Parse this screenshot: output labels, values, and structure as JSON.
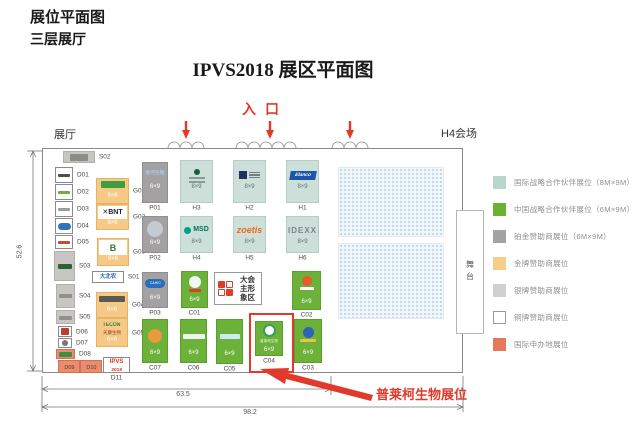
{
  "page": {
    "heading1": "展位平面图",
    "heading2": "三层展厅",
    "title": "IPVS2018 展区平面图",
    "entrance": "入口",
    "hall_left_label": "展厅",
    "hall_right_label": "H4会场",
    "stage_label": "舞台",
    "conference_area": {
      "line1": "大会",
      "line2": "主形象区"
    },
    "callout": "普莱柯生物展位"
  },
  "dimensions": {
    "left": "52.6",
    "bottom_inner": "63.5",
    "bottom_outer": "98.2"
  },
  "legend": [
    {
      "label": "国际战略合作伙伴展位（8M×9M）",
      "color": "#b7d6cc"
    },
    {
      "label": "中国战略合作伙伴展位（6M×9M）",
      "color": "#6ab234"
    },
    {
      "label": "铂金赞助商展位（6M×9M）",
      "color": "#a3a3a3"
    },
    {
      "label": "金牌赞助商展位",
      "color": "#f7cd8c"
    },
    {
      "label": "银牌赞助商展位",
      "color": "#d2cfcf"
    },
    {
      "label": "铜牌赞助商展位",
      "color": "#ffffff",
      "border": "#999999"
    },
    {
      "label": "国际申办地展位",
      "color": "#e8785c"
    }
  ],
  "colors": {
    "booth": {
      "teal": "#ccdfd9",
      "green": "#6cb23a",
      "platinum": "#a3a1a1",
      "gold": "#f6c987",
      "silver": "#c8c6c2",
      "white": "#ffffff",
      "coral": "#e88d6e"
    },
    "border": {
      "teal": "#b2cec6",
      "green": "#58a028",
      "platinum": "#908e8e",
      "gold": "#e3b368",
      "silver": "#b2b0ac",
      "white": "#8a8a8a",
      "coral": "#d2714f"
    },
    "sizetext": {
      "teal": "#60736e",
      "green": "#ffffff",
      "platinum": "#ffffff",
      "gold": "#ffffff",
      "silver": "#555555",
      "white": "#555555",
      "coral": "#ffffff"
    },
    "accent_red": "#e03a2c",
    "wall": "#8a8a8a",
    "dim": "#777777"
  },
  "booths": [
    {
      "id": "S02",
      "x": 63,
      "y": 151,
      "w": 32,
      "h": 12,
      "fill": "silver",
      "label": "S02",
      "side": "right",
      "logo": {
        "kind": "chip",
        "bg": "#8d8d85",
        "w": 18,
        "h": 7,
        "mt": 2
      }
    },
    {
      "id": "D01",
      "x": 55,
      "y": 167,
      "w": 18,
      "h": 16,
      "fill": "white",
      "label": "D01",
      "side": "right",
      "logo": {
        "kind": "chip",
        "bg": "#50504e",
        "w": 12,
        "h": 3,
        "mt": 6
      }
    },
    {
      "id": "D02",
      "x": 55,
      "y": 184,
      "w": 18,
      "h": 16,
      "fill": "white",
      "label": "D02",
      "side": "right",
      "logo": {
        "kind": "chip",
        "bg": "#6fae3e",
        "w": 12,
        "h": 3,
        "mt": 6
      }
    },
    {
      "id": "D03",
      "x": 55,
      "y": 201,
      "w": 18,
      "h": 16,
      "fill": "white",
      "label": "D03",
      "side": "right",
      "logo": {
        "kind": "chip",
        "bg": "#9c9c9c",
        "w": 12,
        "h": 3,
        "mt": 6
      }
    },
    {
      "id": "D04",
      "x": 55,
      "y": 218,
      "w": 18,
      "h": 16,
      "fill": "white",
      "label": "D04",
      "side": "right",
      "logo": {
        "kind": "pill",
        "bg": "#2f74ba",
        "w": 13,
        "h": 7,
        "mt": 4
      }
    },
    {
      "id": "D05",
      "x": 55,
      "y": 235,
      "w": 18,
      "h": 14,
      "fill": "white",
      "label": "D05",
      "side": "right",
      "logo": {
        "kind": "chip",
        "bg": "#cc4b36",
        "w": 12,
        "h": 3,
        "mt": 5
      }
    },
    {
      "id": "S03",
      "x": 54,
      "y": 251,
      "w": 21,
      "h": 30,
      "fill": "silver",
      "label": "S03",
      "side": "right",
      "logo": {
        "kind": "chip",
        "bg": "#315f35",
        "w": 14,
        "h": 5,
        "mt": 12
      }
    },
    {
      "id": "S04",
      "x": 56,
      "y": 284,
      "w": 19,
      "h": 24,
      "fill": "silver",
      "label": "S04",
      "side": "right",
      "logo": {
        "kind": "chip",
        "bg": "#8f8f8f",
        "w": 13,
        "h": 4,
        "mt": 9
      }
    },
    {
      "id": "S05",
      "x": 56,
      "y": 310,
      "w": 19,
      "h": 14,
      "fill": "silver",
      "label": "S05",
      "side": "right",
      "logo": {
        "kind": "chip",
        "bg": "#909090",
        "w": 13,
        "h": 4,
        "mt": 5
      }
    },
    {
      "id": "D06",
      "x": 58,
      "y": 326,
      "w": 14,
      "h": 11,
      "fill": "white",
      "label": "D06",
      "side": "right",
      "logo": {
        "kind": "chip",
        "bg": "#c13b2e",
        "w": 8,
        "h": 7,
        "mt": 1
      }
    },
    {
      "id": "D07",
      "x": 58,
      "y": 338,
      "w": 14,
      "h": 10,
      "fill": "white",
      "label": "D07",
      "side": "right",
      "logo": {
        "kind": "circle",
        "bg": "#777777",
        "d": 6,
        "mt": 1
      }
    },
    {
      "id": "D08",
      "x": 56,
      "y": 349,
      "w": 19,
      "h": 10,
      "fill": "coral",
      "label": "D08",
      "side": "right",
      "logo": {
        "kind": "chip",
        "bg": "#3f8f3f",
        "w": 13,
        "h": 5,
        "mt": 2
      }
    },
    {
      "id": "D09",
      "x": 58,
      "y": 360,
      "w": 22,
      "h": 13,
      "fill": "coral",
      "inner": "D09"
    },
    {
      "id": "D10",
      "x": 80,
      "y": 360,
      "w": 22,
      "h": 13,
      "fill": "coral",
      "inner": "D10"
    },
    {
      "id": "D11",
      "x": 103,
      "y": 357,
      "w": 27,
      "h": 16,
      "fill": "white",
      "label": "D11",
      "side": "bottom",
      "logo": {
        "kind": "stack",
        "gap": 0,
        "mt": 1,
        "items": [
          {
            "kind": "text",
            "text": "IPVS",
            "color": "#d43a2a",
            "size": 6,
            "weight": 700
          },
          {
            "kind": "text",
            "text": "2018",
            "color": "#d43a2a",
            "size": 6,
            "scale": 0.8,
            "weight": 700
          }
        ]
      }
    },
    {
      "id": "G01",
      "x": 96,
      "y": 178,
      "w": 33,
      "h": 26,
      "fill": "gold",
      "size": "6×6",
      "sy": 4,
      "label": "G01",
      "side": "right",
      "logo": {
        "kind": "chip",
        "bg": "#3f9e3f",
        "w": 24,
        "h": 7,
        "mt": 2
      }
    },
    {
      "id": "G02",
      "x": 96,
      "y": 204,
      "w": 33,
      "h": 26,
      "fill": "gold",
      "size": "6×6",
      "sy": 3,
      "label": "G02",
      "side": "right",
      "logo": {
        "kind": "banner",
        "bg": "#ffffff",
        "w": 29,
        "h": 13,
        "text": "✕BNT",
        "color": "#222222",
        "size": 7,
        "weight": 700,
        "mt": 1
      }
    },
    {
      "id": "G03",
      "x": 97,
      "y": 238,
      "w": 32,
      "h": 28,
      "fill": "gold",
      "size": "6×6",
      "sy": 3,
      "label": "G03",
      "side": "right",
      "logo": {
        "kind": "banner",
        "bg": "#ffffff",
        "w": 28,
        "h": 15,
        "text": "B",
        "color": "#2e7d32",
        "size": 9,
        "weight": 700,
        "mt": 1
      }
    },
    {
      "id": "S01",
      "x": 92,
      "y": 271,
      "w": 32,
      "h": 12,
      "fill": "white",
      "label": "S01",
      "side": "right",
      "logo": {
        "kind": "text",
        "text": "大北农",
        "color": "#1b5fb0",
        "size": 6,
        "scale": 0.9,
        "weight": 700,
        "mt": 2
      }
    },
    {
      "id": "G04",
      "x": 96,
      "y": 292,
      "w": 32,
      "h": 26,
      "fill": "gold",
      "size": "6×6",
      "sy": 4,
      "label": "G04",
      "side": "right",
      "logo": {
        "kind": "chip",
        "bg": "#5a5a52",
        "w": 26,
        "h": 6,
        "mt": 3
      }
    },
    {
      "id": "G05",
      "x": 96,
      "y": 318,
      "w": 32,
      "h": 29,
      "fill": "gold",
      "size": "6×6",
      "sy": 3,
      "label": "G05",
      "side": "right",
      "logo": {
        "kind": "stack",
        "gap": 0,
        "mt": 3,
        "items": [
          {
            "kind": "text",
            "text": "TECON",
            "color": "#2f7d3a",
            "size": 6,
            "scale": 0.85,
            "weight": 700
          },
          {
            "kind": "text",
            "text": "天康生物",
            "color": "#8a3a2a",
            "size": 6,
            "scale": 0.75
          }
        ]
      }
    },
    {
      "id": "P01",
      "x": 142,
      "y": 162,
      "w": 26,
      "h": 41,
      "fill": "platinum",
      "size": "6×9",
      "sy": 12,
      "label": "P01",
      "side": "bottom",
      "logo": {
        "kind": "text",
        "text": "金河生物",
        "color": "#a9c9ea",
        "size": 6,
        "scale": 0.8,
        "weight": 700,
        "mt": 7
      }
    },
    {
      "id": "P02",
      "x": 142,
      "y": 216,
      "w": 26,
      "h": 37,
      "fill": "platinum",
      "size": "6×9",
      "sy": 6,
      "label": "P02",
      "side": "bottom",
      "logo": {
        "kind": "circle",
        "bg": "#c2cbd2",
        "d": 16,
        "mt": 4
      }
    },
    {
      "id": "P03",
      "x": 142,
      "y": 272,
      "w": 26,
      "h": 36,
      "fill": "platinum",
      "size": "6×9",
      "sy": 6,
      "label": "P03",
      "side": "bottom",
      "logo": {
        "kind": "pill",
        "bg": "#2a6db8",
        "w": 20,
        "h": 9,
        "text": "CAHIC",
        "color": "#ffffff",
        "size": 6,
        "scale": 0.6,
        "mt": 6
      }
    },
    {
      "id": "H3",
      "x": 180,
      "y": 160,
      "w": 33,
      "h": 43,
      "fill": "teal",
      "size": "8×9",
      "sy": 12,
      "label": "H3",
      "side": "bottom",
      "logo": {
        "kind": "dotlines",
        "dot": "#1d5c3c",
        "lines": "#8a9a94",
        "mt": 8
      }
    },
    {
      "id": "H2",
      "x": 233,
      "y": 160,
      "w": 33,
      "h": 43,
      "fill": "teal",
      "size": "8×9",
      "sy": 12,
      "label": "H2",
      "side": "bottom",
      "logo": {
        "kind": "chiplines",
        "sq": "#1d2f5e",
        "lines": "#6f7f8a",
        "mt": 10
      }
    },
    {
      "id": "H1",
      "x": 286,
      "y": 160,
      "w": 33,
      "h": 43,
      "fill": "teal",
      "size": "8×9",
      "sy": 12,
      "label": "H1",
      "side": "bottom",
      "logo": {
        "kind": "banner",
        "bg": "#1b57a6",
        "w": 26,
        "h": 9,
        "skew": -10,
        "text": "Elanco",
        "color": "#ffffff",
        "size": 6,
        "scale": 0.8,
        "weight": 700,
        "italic": true,
        "mt": 10
      }
    },
    {
      "id": "H4",
      "x": 180,
      "y": 216,
      "w": 33,
      "h": 37,
      "fill": "teal",
      "size": "8×9",
      "sy": 7,
      "label": "H4",
      "side": "bottom",
      "logo": {
        "kind": "stack",
        "dir": "row",
        "gap": 2,
        "mt": 9,
        "items": [
          {
            "kind": "circle",
            "bg": "#00a08a",
            "d": 7
          },
          {
            "kind": "text",
            "text": "MSD",
            "color": "#00715f",
            "size": 7,
            "weight": 700
          }
        ]
      }
    },
    {
      "id": "H5",
      "x": 233,
      "y": 216,
      "w": 33,
      "h": 37,
      "fill": "teal",
      "size": "8×9",
      "sy": 7,
      "label": "H5",
      "side": "bottom",
      "logo": {
        "kind": "text",
        "text": "zoetis",
        "color": "#ef6821",
        "size": 9,
        "weight": 700,
        "italic": true,
        "mt": 8
      }
    },
    {
      "id": "H6",
      "x": 286,
      "y": 216,
      "w": 33,
      "h": 37,
      "fill": "teal",
      "size": "8×9",
      "sy": 7,
      "label": "H6",
      "side": "bottom",
      "logo": {
        "kind": "text",
        "text": "IDEXX",
        "color": "#7d838a",
        "size": 8,
        "weight": 700,
        "ls": 1,
        "mt": 9
      }
    },
    {
      "id": "C01",
      "x": 181,
      "y": 271,
      "w": 27,
      "h": 37,
      "fill": "green",
      "size": "6×9",
      "sy": 4,
      "label": "C01",
      "side": "bottom",
      "logo": {
        "kind": "stack",
        "gap": 1,
        "mt": 4,
        "items": [
          {
            "kind": "circle",
            "bg": "#f2f7ee",
            "d": 12
          },
          {
            "kind": "chip",
            "bg": "#d8402c",
            "w": 12,
            "h": 3
          }
        ]
      }
    },
    {
      "id": "C02",
      "x": 292,
      "y": 271,
      "w": 29,
      "h": 39,
      "fill": "green",
      "size": "6×9",
      "sy": 4,
      "label": "C02",
      "side": "bottom",
      "logo": {
        "kind": "stack",
        "gap": 1,
        "mt": 4,
        "items": [
          {
            "kind": "circle",
            "bg": "#e85a2a",
            "d": 10
          },
          {
            "kind": "chip",
            "bg": "#ffffff",
            "w": 14,
            "h": 3
          }
        ]
      }
    },
    {
      "id": "C07",
      "x": 142,
      "y": 319,
      "w": 26,
      "h": 44,
      "fill": "green",
      "size": "6×9",
      "sy": 6,
      "label": "C07",
      "side": "bottom",
      "logo": {
        "kind": "circle",
        "bg": "#e89a3c",
        "d": 14,
        "mt": 9
      }
    },
    {
      "id": "C06",
      "x": 180,
      "y": 319,
      "w": 27,
      "h": 44,
      "fill": "green",
      "size": "6×9",
      "sy": 6,
      "label": "C06",
      "side": "bottom",
      "logo": {
        "kind": "chip",
        "bg": "#f0f4f0",
        "w": 22,
        "h": 5,
        "mt": 14
      }
    },
    {
      "id": "C05",
      "x": 216,
      "y": 319,
      "w": 27,
      "h": 45,
      "fill": "green",
      "size": "6×9",
      "sy": 6,
      "label": "C05",
      "side": "bottom",
      "logo": {
        "kind": "chip",
        "bg": "#cfe9f7",
        "w": 20,
        "h": 5,
        "mt": 14
      }
    },
    {
      "id": "C04",
      "x": 255,
      "y": 321,
      "w": 28,
      "h": 35,
      "fill": "green",
      "size": "6×9",
      "sy": 2,
      "label": "C04",
      "side": "bottom",
      "logo": {
        "kind": "stack",
        "gap": 1,
        "mt": 2,
        "items": [
          {
            "kind": "circle",
            "bg": "#ffffff",
            "d": 13,
            "ring": "#35a05a"
          },
          {
            "kind": "text",
            "text": "普莱柯生物",
            "color": "#eaf5e0",
            "size": 6,
            "scale": 0.6
          }
        ]
      }
    },
    {
      "id": "C03",
      "x": 294,
      "y": 319,
      "w": 28,
      "h": 44,
      "fill": "green",
      "size": "6×9",
      "sy": 6,
      "label": "C03",
      "side": "bottom",
      "logo": {
        "kind": "stack",
        "gap": 1,
        "mt": 7,
        "items": [
          {
            "kind": "circle",
            "bg": "#2a66b4",
            "d": 11
          },
          {
            "kind": "chip",
            "bg": "#e8c53a",
            "w": 16,
            "h": 3
          }
        ]
      }
    }
  ]
}
